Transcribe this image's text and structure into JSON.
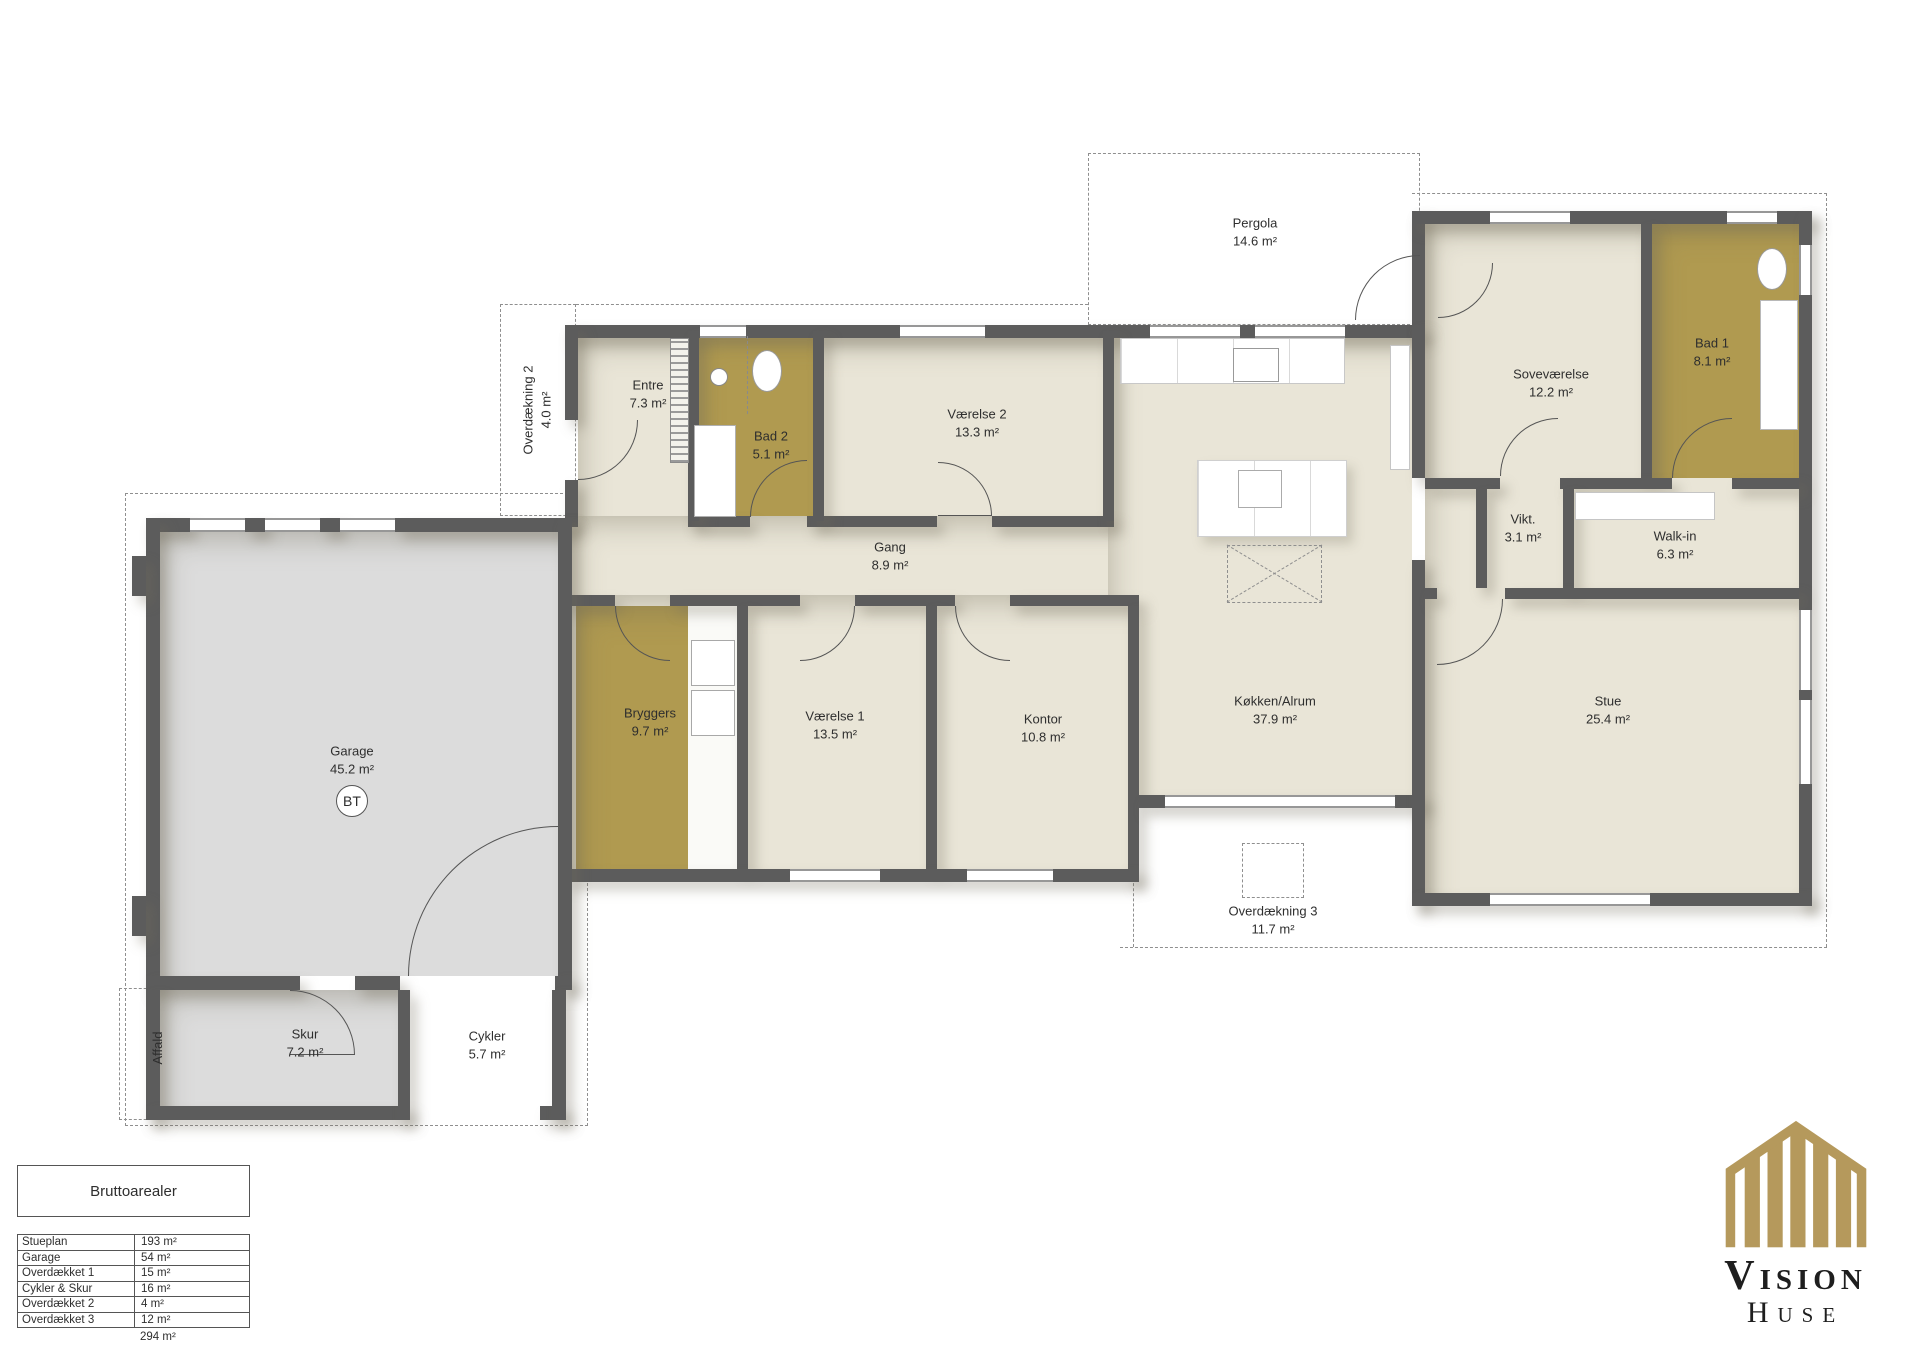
{
  "colors": {
    "floor": "#e9e5d7",
    "wet": "#b09a50",
    "garage": "#dcdcdc",
    "wall": "#5c5c5c",
    "logo-gold": "#b5995c"
  },
  "plan": {
    "rooms": {
      "entre": {
        "name": "Entre",
        "area": "7.3 m²"
      },
      "bad2": {
        "name": "Bad 2",
        "area": "5.1 m²"
      },
      "vaerelse2": {
        "name": "Værelse 2",
        "area": "13.3 m²"
      },
      "gang": {
        "name": "Gang",
        "area": "8.9 m²"
      },
      "bryggers": {
        "name": "Bryggers",
        "area": "9.7 m²"
      },
      "vaerelse1": {
        "name": "Værelse 1",
        "area": "13.5 m²"
      },
      "kontor": {
        "name": "Kontor",
        "area": "10.8 m²"
      },
      "koekken": {
        "name": "Køkken/Alrum",
        "area": "37.9 m²"
      },
      "sovevaerelse": {
        "name": "Soveværelse",
        "area": "12.2 m²"
      },
      "bad1": {
        "name": "Bad 1",
        "area": "8.1 m²"
      },
      "vikt": {
        "name": "Vikt.",
        "area": "3.1 m²"
      },
      "walkin": {
        "name": "Walk-in",
        "area": "6.3 m²"
      },
      "stue": {
        "name": "Stue",
        "area": "25.4 m²"
      },
      "garage": {
        "name": "Garage",
        "area": "45.2 m²"
      },
      "skur": {
        "name": "Skur",
        "area": "7.2 m²"
      },
      "cykler": {
        "name": "Cykler",
        "area": "5.7 m²"
      },
      "pergola": {
        "name": "Pergola",
        "area": "14.6 m²"
      },
      "overdaekning2": {
        "name": "Overdækning 2",
        "area": "4.0 m²"
      },
      "overdaekning3": {
        "name": "Overdækning 3",
        "area": "11.7 m²"
      },
      "affald": {
        "name": "Affald"
      }
    },
    "garage_badge": "BT"
  },
  "areas_table": {
    "title": "Bruttoarealer",
    "rows": [
      {
        "label": "Stueplan",
        "value": "193 m²"
      },
      {
        "label": "Garage",
        "value": "54 m²"
      },
      {
        "label": "Overdækket 1",
        "value": "15 m²"
      },
      {
        "label": "Cykler & Skur",
        "value": "16 m²"
      },
      {
        "label": "Overdækket 2",
        "value": "4 m²"
      },
      {
        "label": "Overdækket 3",
        "value": "12 m²"
      }
    ],
    "total": "294 m²"
  },
  "logo": {
    "brand": "Vision",
    "suffix": "Huse"
  }
}
